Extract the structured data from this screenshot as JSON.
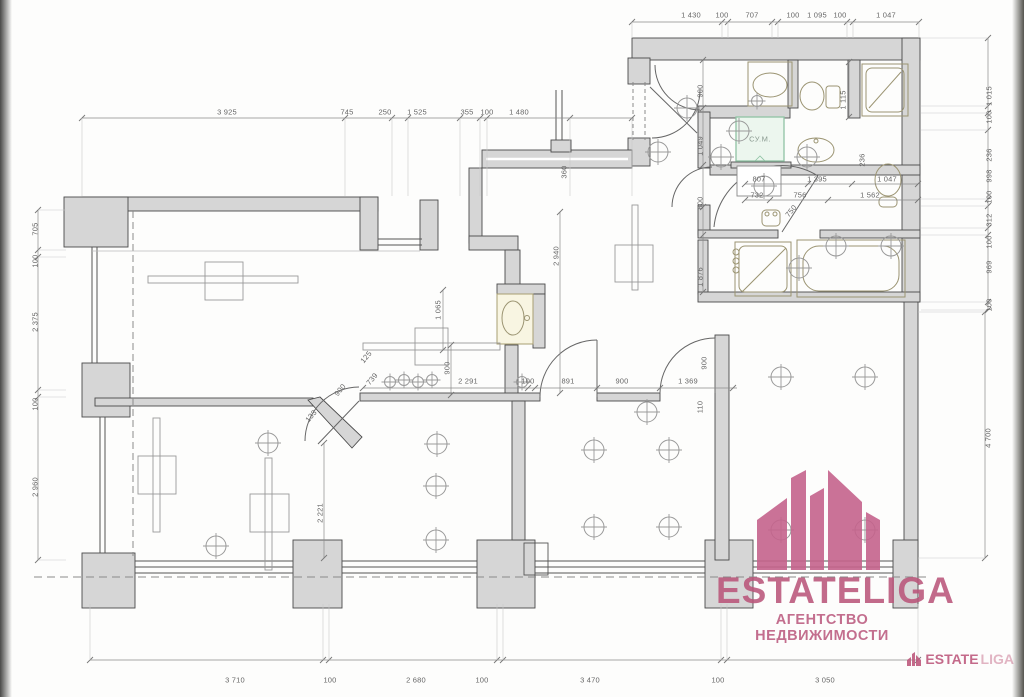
{
  "labels": {
    "sym": "СУ.М."
  },
  "watermark": {
    "brand": "ESTATELIGA",
    "tagline": "АГЕНТСТВО НЕДВИЖИМОСТИ",
    "corner_brand_a": "ESTATE",
    "corner_brand_b": "LIGA",
    "color": "#b9557a"
  },
  "colors": {
    "wall_fill": "#d6d6d6",
    "wall_line": "#4a4a4a",
    "dim_line": "#8a8a8a",
    "fixture": "#9b9472",
    "light": "#9a9a9a",
    "accent_green": "#8fc3a4",
    "brand_pink": "#c4638c"
  },
  "plan": {
    "dim_labels": [
      {
        "t": "1 430",
        "x": 691,
        "y": 15
      },
      {
        "t": "100",
        "x": 722,
        "y": 15
      },
      {
        "t": "707",
        "x": 752,
        "y": 15
      },
      {
        "t": "100",
        "x": 793,
        "y": 15
      },
      {
        "t": "1 095",
        "x": 817,
        "y": 15
      },
      {
        "t": "100",
        "x": 840,
        "y": 15
      },
      {
        "t": "1 047",
        "x": 886,
        "y": 15
      },
      {
        "t": "3 925",
        "x": 227,
        "y": 112
      },
      {
        "t": "745",
        "x": 347,
        "y": 112
      },
      {
        "t": "250",
        "x": 385,
        "y": 112
      },
      {
        "t": "1 525",
        "x": 417,
        "y": 112
      },
      {
        "t": "355",
        "x": 467,
        "y": 112
      },
      {
        "t": "100",
        "x": 487,
        "y": 112
      },
      {
        "t": "1 480",
        "x": 519,
        "y": 112
      },
      {
        "t": "705",
        "x": 35,
        "y": 229,
        "r": -90
      },
      {
        "t": "100",
        "x": 35,
        "y": 261,
        "r": -90
      },
      {
        "t": "2 375",
        "x": 35,
        "y": 322,
        "r": -90
      },
      {
        "t": "100",
        "x": 35,
        "y": 404,
        "r": -90
      },
      {
        "t": "2 960",
        "x": 35,
        "y": 487,
        "r": -90
      },
      {
        "t": "1 015",
        "x": 989,
        "y": 96,
        "r": -90
      },
      {
        "t": "100",
        "x": 989,
        "y": 117,
        "r": -90
      },
      {
        "t": "236",
        "x": 989,
        "y": 155,
        "r": -90
      },
      {
        "t": "998",
        "x": 989,
        "y": 176,
        "r": -90
      },
      {
        "t": "100",
        "x": 989,
        "y": 197,
        "r": -90
      },
      {
        "t": "312",
        "x": 989,
        "y": 220,
        "r": -90
      },
      {
        "t": "100",
        "x": 989,
        "y": 242,
        "r": -90
      },
      {
        "t": "969",
        "x": 989,
        "y": 267,
        "r": -90
      },
      {
        "t": "100",
        "x": 989,
        "y": 305,
        "r": -90
      },
      {
        "t": "4 700",
        "x": 988,
        "y": 438,
        "r": -90
      },
      {
        "t": "3 710",
        "x": 235,
        "y": 680
      },
      {
        "t": "100",
        "x": 330,
        "y": 680
      },
      {
        "t": "2 680",
        "x": 416,
        "y": 680
      },
      {
        "t": "100",
        "x": 482,
        "y": 680
      },
      {
        "t": "3 470",
        "x": 590,
        "y": 680
      },
      {
        "t": "100",
        "x": 718,
        "y": 680
      },
      {
        "t": "3 050",
        "x": 825,
        "y": 680
      },
      {
        "t": "2 940",
        "x": 556,
        "y": 256,
        "r": -90
      },
      {
        "t": "360",
        "x": 564,
        "y": 172,
        "r": -90
      },
      {
        "t": "1 049",
        "x": 700,
        "y": 146,
        "r": -90
      },
      {
        "t": "900",
        "x": 700,
        "y": 91,
        "r": -90
      },
      {
        "t": "800",
        "x": 700,
        "y": 203,
        "r": -90
      },
      {
        "t": "1 876",
        "x": 700,
        "y": 277,
        "r": -90
      },
      {
        "t": "1 115",
        "x": 843,
        "y": 100,
        "r": -90
      },
      {
        "t": "236",
        "x": 862,
        "y": 160,
        "r": -90
      },
      {
        "t": "1 065",
        "x": 438,
        "y": 310,
        "r": -90
      },
      {
        "t": "900",
        "x": 447,
        "y": 368,
        "r": -90
      },
      {
        "t": "900",
        "x": 704,
        "y": 363,
        "r": -90
      },
      {
        "t": "110",
        "x": 700,
        "y": 407,
        "r": -90
      },
      {
        "t": "2 221",
        "x": 320,
        "y": 513,
        "r": -90
      },
      {
        "t": "807",
        "x": 759,
        "y": 179
      },
      {
        "t": "1 395",
        "x": 817,
        "y": 179
      },
      {
        "t": "1 047",
        "x": 887,
        "y": 179
      },
      {
        "t": "732",
        "x": 757,
        "y": 195
      },
      {
        "t": "756",
        "x": 800,
        "y": 195
      },
      {
        "t": "1 562",
        "x": 870,
        "y": 195
      },
      {
        "t": "2 291",
        "x": 468,
        "y": 381
      },
      {
        "t": "100",
        "x": 528,
        "y": 381
      },
      {
        "t": "891",
        "x": 568,
        "y": 381
      },
      {
        "t": "900",
        "x": 622,
        "y": 381
      },
      {
        "t": "1 369",
        "x": 688,
        "y": 381
      },
      {
        "t": "750",
        "x": 791,
        "y": 211,
        "r": -50
      },
      {
        "t": "125",
        "x": 366,
        "y": 357,
        "r": -50
      },
      {
        "t": "739",
        "x": 372,
        "y": 379,
        "r": -50
      },
      {
        "t": "900",
        "x": 340,
        "y": 390,
        "r": -50
      },
      {
        "t": "133",
        "x": 311,
        "y": 416,
        "r": -50
      }
    ],
    "dim_lines": [
      {
        "x1": 632,
        "x2": 919,
        "y": 22,
        "ticks": [
          632,
          722,
          728,
          772,
          778,
          847,
          853,
          919
        ],
        "ext": 38
      },
      {
        "x1": 82,
        "x2": 632,
        "y": 118,
        "ticks": [
          82,
          345,
          392,
          408,
          460,
          480,
          487,
          570,
          632
        ],
        "ext": 196
      },
      {
        "x1": 90,
        "x2": 918,
        "y": 660,
        "ticks": [
          90,
          323,
          329,
          497,
          503,
          721,
          727,
          918
        ],
        "ext": 604
      },
      {
        "x1": 363,
        "x2": 737,
        "y": 388,
        "ticks": [
          363,
          528,
          535,
          597,
          660,
          733
        ]
      },
      {
        "x1": 745,
        "x2": 918,
        "y": 184,
        "ticks": [
          745,
          808,
          852,
          918
        ]
      },
      {
        "x1": 745,
        "x2": 918,
        "y": 200,
        "ticks": [
          745,
          770,
          828,
          918
        ]
      },
      {
        "v": 1,
        "x": 38,
        "y1": 210,
        "y2": 560,
        "ticks": [
          210,
          250,
          257,
          390,
          397,
          560
        ],
        "ext": 66
      },
      {
        "v": 1,
        "x": 988,
        "y1": 38,
        "y2": 310,
        "ticks": [
          38,
          106,
          113,
          130,
          199,
          206,
          228,
          235,
          302,
          310
        ],
        "ext": 921
      },
      {
        "v": 1,
        "x": 985,
        "y1": 312,
        "y2": 558,
        "ticks": [
          312,
          558
        ],
        "ext": 918
      },
      {
        "v": 1,
        "x": 703,
        "y1": 60,
        "y2": 292,
        "ticks": [
          60,
          108,
          165,
          207,
          235,
          292
        ]
      },
      {
        "v": 1,
        "x": 560,
        "y1": 212,
        "y2": 393,
        "ticks": [
          212,
          393
        ]
      },
      {
        "v": 1,
        "x": 443,
        "y1": 290,
        "y2": 350,
        "ticks": [
          290,
          350
        ]
      },
      {
        "v": 1,
        "x": 451,
        "y1": 345,
        "y2": 395,
        "ticks": [
          345,
          395
        ]
      },
      {
        "v": 1,
        "x": 324,
        "y1": 443,
        "y2": 558,
        "ticks": [
          443,
          558
        ]
      },
      {
        "v": 1,
        "x": 849,
        "y1": 62,
        "y2": 117,
        "ticks": [
          62,
          117
        ]
      }
    ],
    "lights_large": [
      [
        658,
        152
      ],
      [
        687,
        108
      ],
      [
        739,
        131
      ],
      [
        807,
        157
      ],
      [
        721,
        157
      ],
      [
        764,
        186
      ],
      [
        799,
        268
      ],
      [
        836,
        246
      ],
      [
        891,
        246
      ],
      [
        594,
        450
      ],
      [
        669,
        450
      ],
      [
        594,
        527
      ],
      [
        669,
        527
      ],
      [
        781,
        377
      ],
      [
        865,
        377
      ],
      [
        781,
        530
      ],
      [
        865,
        530
      ],
      [
        437,
        444
      ],
      [
        436,
        486
      ],
      [
        436,
        540
      ],
      [
        268,
        443
      ],
      [
        216,
        546
      ],
      [
        647,
        412
      ]
    ],
    "lights_small": [
      [
        522,
        382
      ],
      [
        390,
        382
      ],
      [
        404,
        380
      ],
      [
        418,
        382
      ],
      [
        432,
        380
      ],
      [
        757,
        101
      ]
    ]
  }
}
